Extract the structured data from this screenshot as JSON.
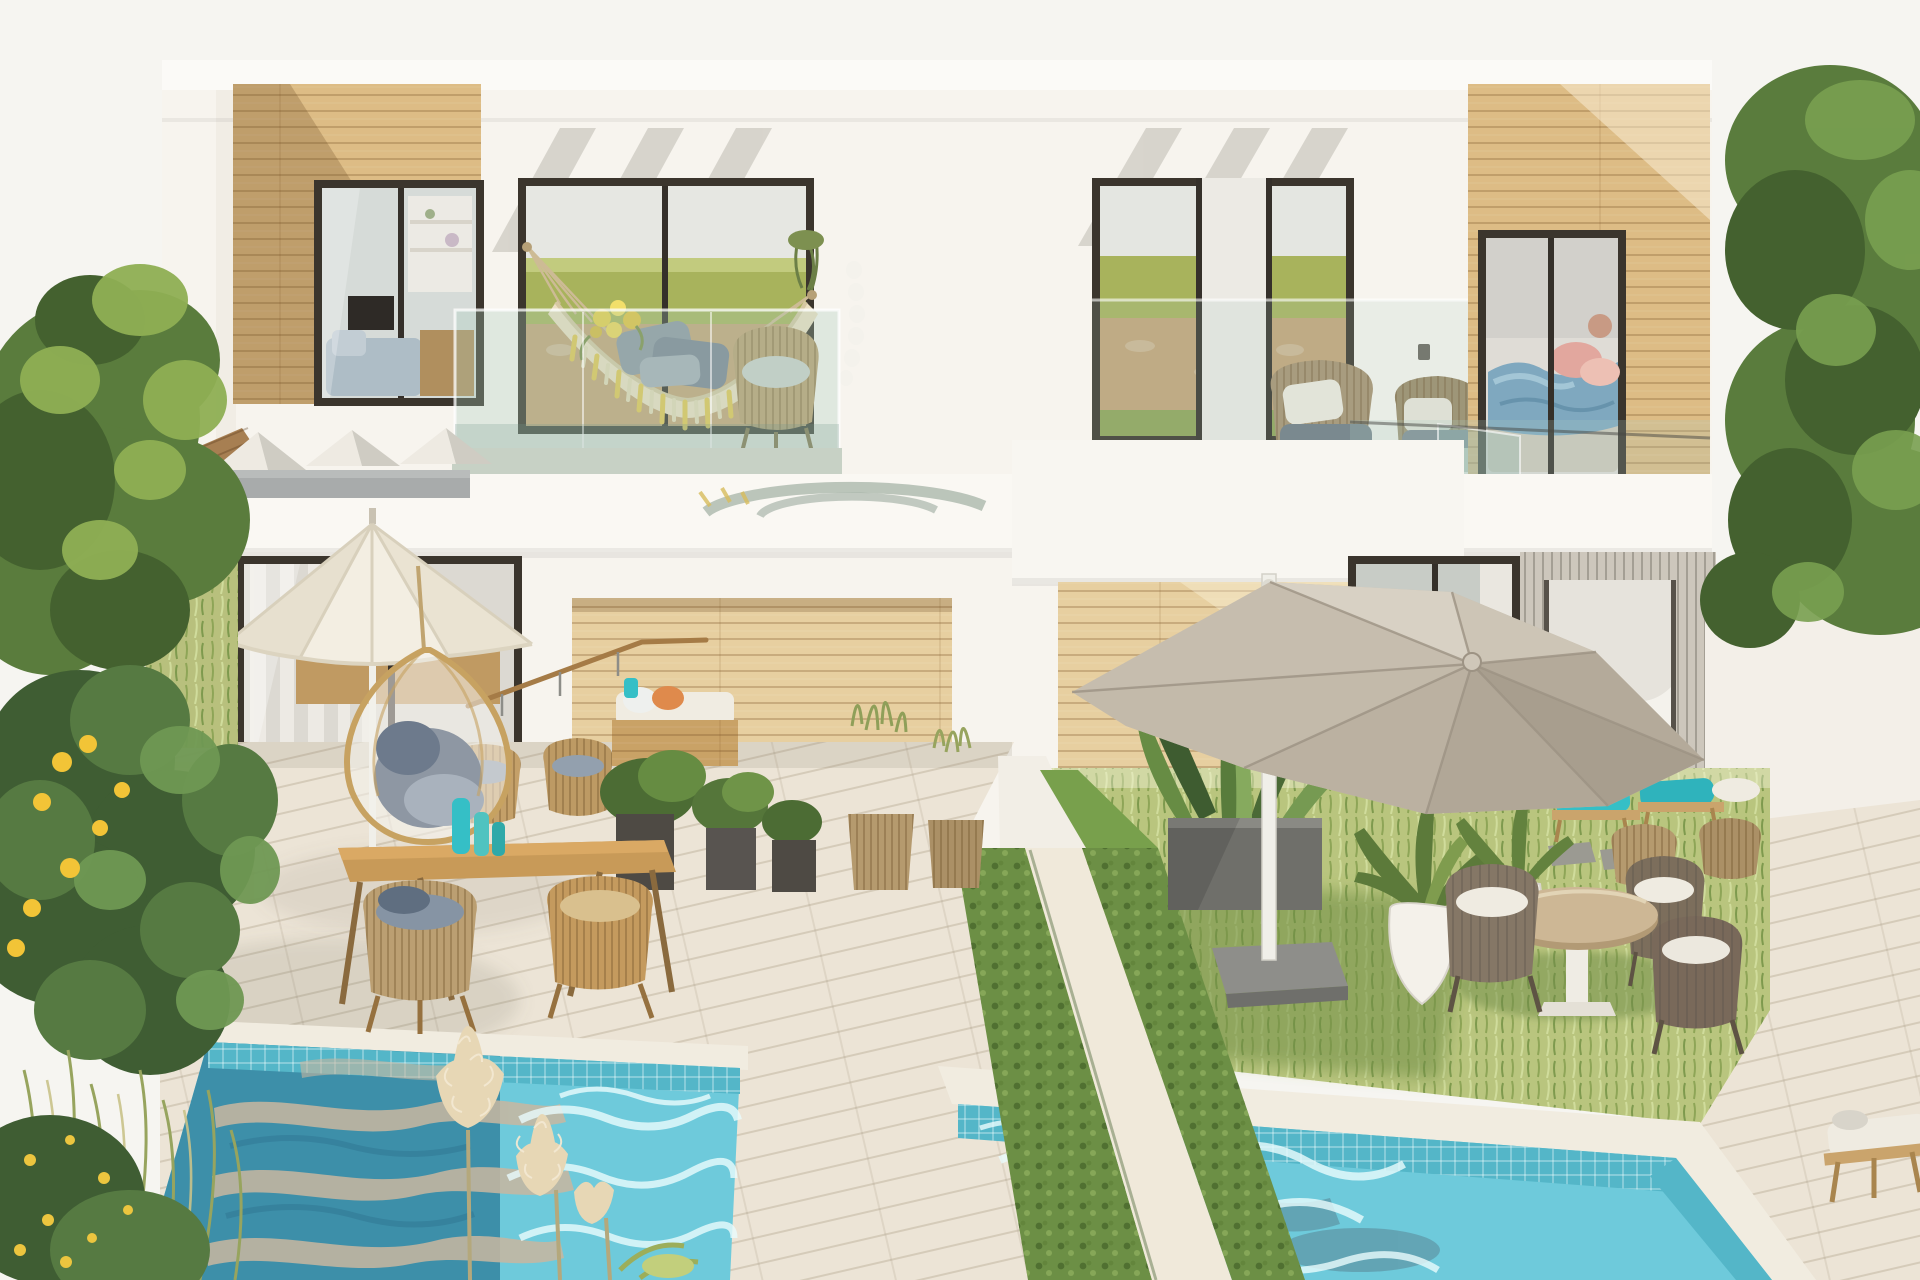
{
  "scene": {
    "title": "Modern two-storey duplex villa exterior with balconies, patios and two plunge pools",
    "type": "architectural-render",
    "time_of_day": "sunny daylight",
    "objects": [
      {
        "name": "left-wood-cladding",
        "desc": "upper-left wood plank facade with diagonal sun shadow"
      },
      {
        "name": "left-window",
        "desc": "dark-framed window showing shelves, TV and blue-grey sofa"
      },
      {
        "name": "hammock-balcony",
        "desc": "upper balcony with cream hammock, yellow tassels, grey pillows, yellow flowers, wicker chair, glass railing"
      },
      {
        "name": "right-balcony",
        "desc": "upper terrace with two wicker armchairs, round wood coffee table, glass railing"
      },
      {
        "name": "bedroom-window",
        "desc": "sliding glass door revealing bed with blue duvet and pink pillows, wood cladding"
      },
      {
        "name": "pergola",
        "desc": "white roof beams casting diagonal shadows"
      },
      {
        "name": "left-patio",
        "desc": "white patio umbrella, hanging egg chair with grey cushions, wood dining table with teal vases, wicker chairs, daybed with orange pillow, potted shrubs"
      },
      {
        "name": "right-garden",
        "desc": "lawn with grey cantilever umbrella on white pole, round table with dark wicker chairs, white plant pots, grey planter, teal sun loungers"
      },
      {
        "name": "hedge-divider",
        "desc": "two diagonal hedge strips with white stone path between the two units"
      },
      {
        "name": "left-pool",
        "desc": "turquoise mosaic-tiled pool, beige deck reflections on water, white caustics"
      },
      {
        "name": "right-pool",
        "desc": "turquoise mosaic-tiled pool with white caustic ripples"
      },
      {
        "name": "pampas-grass",
        "desc": "cream pampas plumes in front of left pool"
      },
      {
        "name": "lemon-tree",
        "desc": "left-side greenery with yellow lemons and flowering shrubs"
      },
      {
        "name": "right-hedge",
        "desc": "tall green hedge along right edge"
      },
      {
        "name": "sun-lounger",
        "desc": "white cushioned lounger on bottom-right stone deck"
      }
    ]
  },
  "palette": {
    "sky": "#f6f5f1",
    "facade": "#f7f4ee",
    "beam_white": "#f1eee7",
    "wood": "#ddbc85",
    "wood_pale": "#e7cfa0",
    "frame_dark": "#3b352d",
    "glass_cool": "#d6dbd8",
    "hill_green": "#a8b35c",
    "stone_wall": "#c4a478",
    "floor_sage": "#c7d1c5",
    "hammock_cream": "#ecdfc2",
    "tassel_yellow": "#e3c654",
    "pillow_gray": "#8e97a3",
    "wicker_tan": "#bb9f72",
    "wicker_dark": "#7c6e5c",
    "cushion_blue": "#8694a4",
    "cushion_white": "#efebe1",
    "umbrella_cream": "#f3eee2",
    "umbrella_taupe": "#c6bdae",
    "pole_white": "#f0efe9",
    "lawn": "#b9c57e",
    "hedge": "#6c8f45",
    "foliage_dark": "#44612f",
    "foliage_mid": "#5a7c3d",
    "foliage_light": "#79a050",
    "lemon": "#f2c437",
    "deck": "#ece4d6",
    "path_white": "#f0e9da",
    "coping": "#f1ece0",
    "tile": "#54b6c8",
    "water_bright": "#6ecadb",
    "water_deep": "#3d8fa9",
    "reflection_beige": "#c9b7a0",
    "teal": "#35bfc6",
    "bed_blue": "#7fa8bf",
    "pink": "#e2a79e",
    "concrete": "#a8abab",
    "roof_wood": "#a77f52",
    "planter_gray": "#6f6f6a",
    "planter_dark": "#4e4a44",
    "pampas": "#e7d7b5",
    "white_pot": "#f4f1ea"
  }
}
